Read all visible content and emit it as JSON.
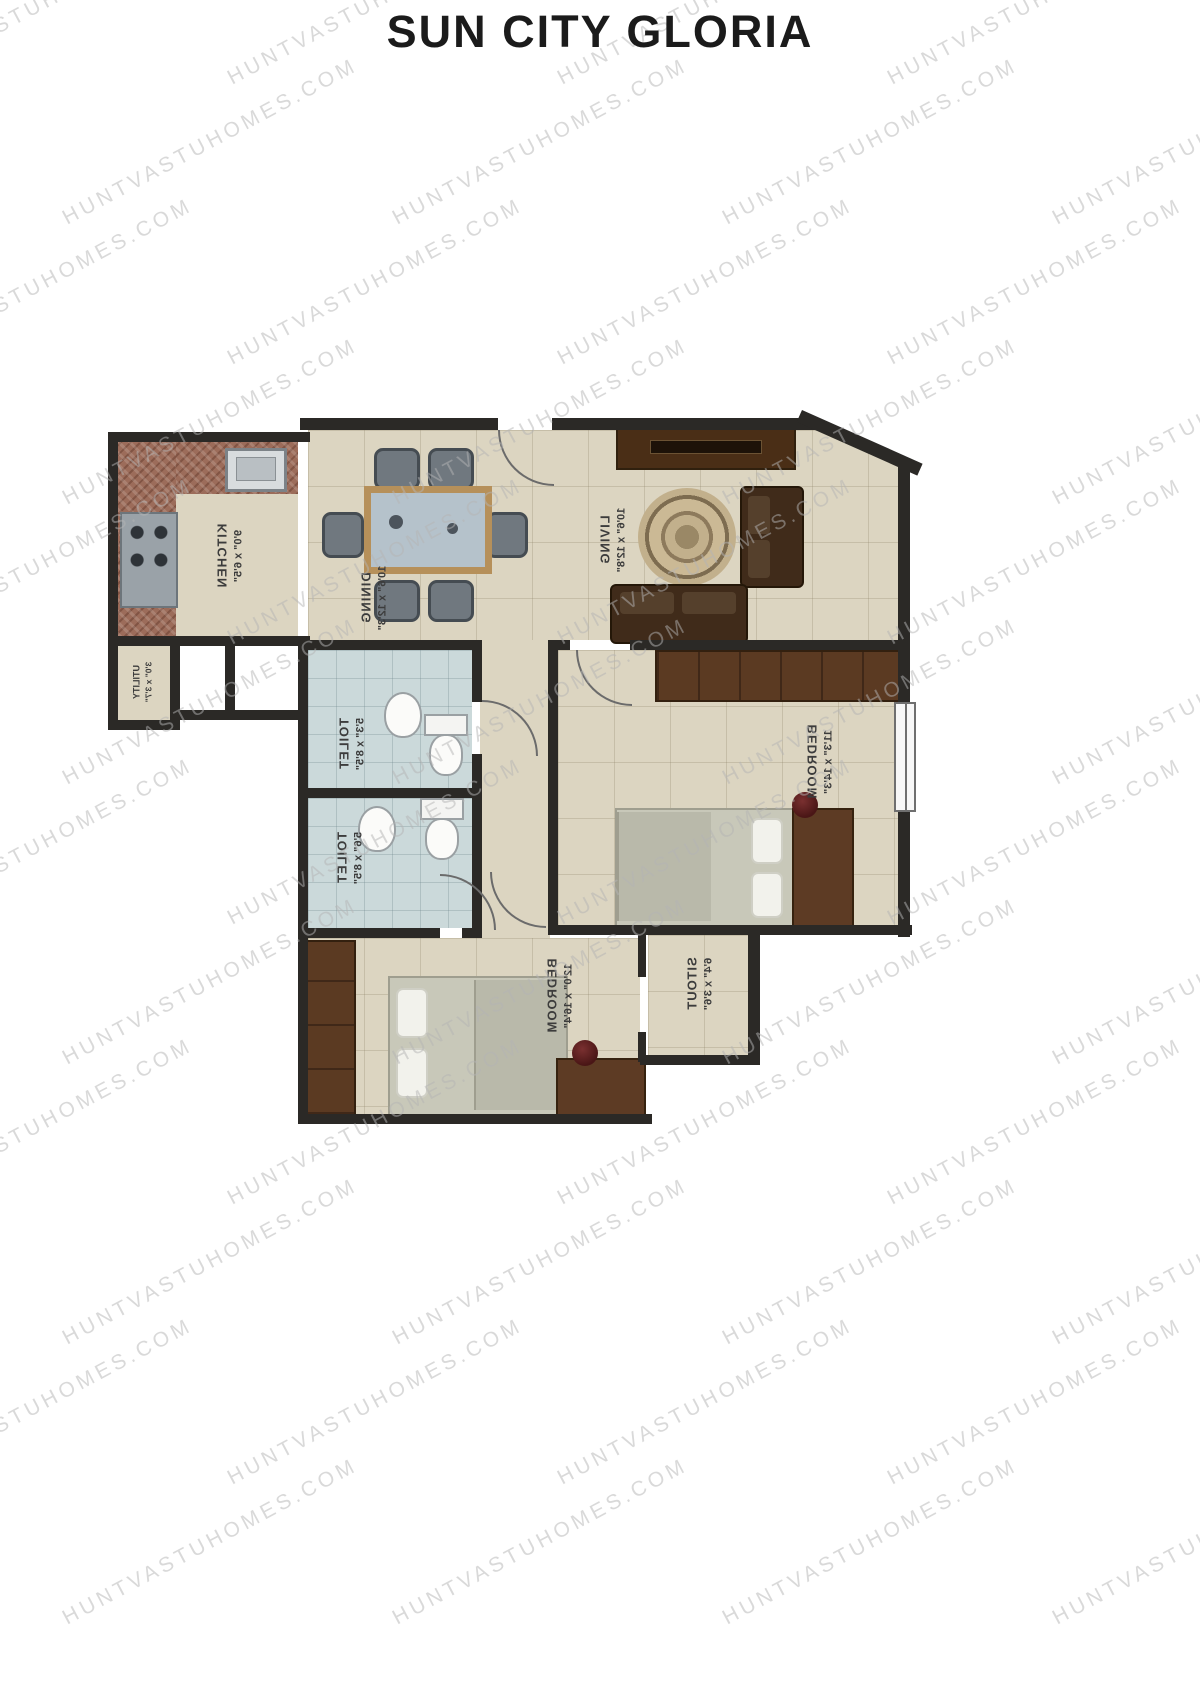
{
  "title": "SUN CITY GLORIA",
  "watermark": "HUNTVASTUHOMES.COM",
  "colors": {
    "wall": "#2b2926",
    "floor": "#dcd5c1",
    "toilet_floor": "#cbd9da",
    "counter": "#9c6c5a",
    "wood_dark": "#5b3a22",
    "label_text": "#3c3c3c",
    "watermark": "#b5b5b5"
  },
  "rooms": [
    {
      "id": "kitchen",
      "name": "KITCHEN",
      "dims": "9'0\" x 6'5\""
    },
    {
      "id": "dining",
      "name": "DINING",
      "dims": "10'6\" x 12'3\""
    },
    {
      "id": "living",
      "name": "LIVING",
      "dims": "10'6\" x 12'8\""
    },
    {
      "id": "utility",
      "name": "UTILITY",
      "dims": "3'0\" x 3'7\""
    },
    {
      "id": "toilet1",
      "name": "TOILET",
      "dims": "5'3\" x 8'5\""
    },
    {
      "id": "toilet2",
      "name": "TOILET",
      "dims": "5'6\" x 8'5\""
    },
    {
      "id": "bedroom1",
      "name": "BEDROOM",
      "dims": "11'3\" x 14'3\""
    },
    {
      "id": "bedroom2",
      "name": "BEDROOM",
      "dims": "12'0\" x 16'4\""
    },
    {
      "id": "sitout",
      "name": "SITOUT",
      "dims": "6'4\" x 3'6\""
    }
  ]
}
